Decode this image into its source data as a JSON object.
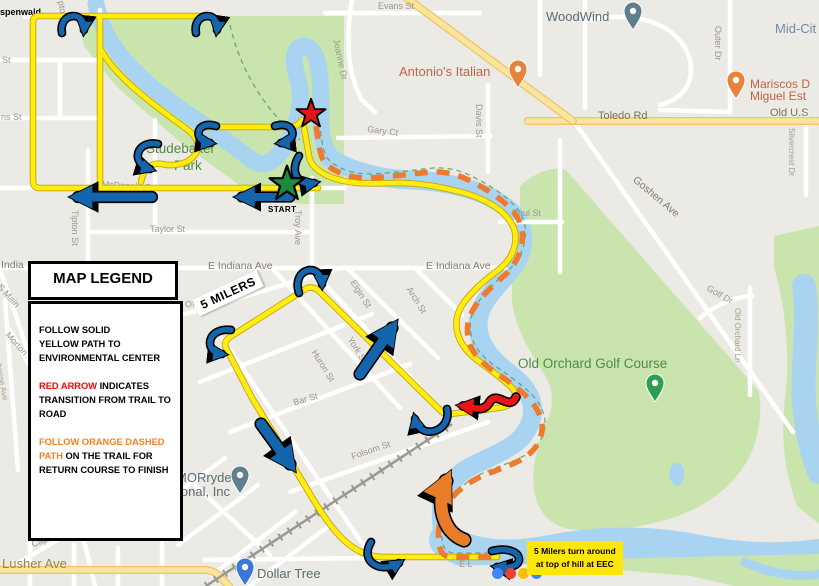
{
  "legend": {
    "title": "MAP LEGEND",
    "blocks": [
      {
        "lines": [
          {
            "parts": [
              {
                "t": "FOLLOW SOLID",
                "c": "#000000"
              }
            ]
          },
          {
            "parts": [
              {
                "t": "YELLOW PATH TO",
                "c": "#000000"
              }
            ]
          },
          {
            "parts": [
              {
                "t": "ENVIRONMENTAL CENTER",
                "c": "#000000"
              }
            ]
          }
        ]
      },
      {
        "lines": [
          {
            "parts": [
              {
                "t": "RED ARROW",
                "c": "#ff0000"
              },
              {
                "t": " INDICATES",
                "c": "#000000"
              }
            ]
          },
          {
            "parts": [
              {
                "t": "TRANSITION FROM TRAIL TO",
                "c": "#000000"
              }
            ]
          },
          {
            "parts": [
              {
                "t": "ROAD",
                "c": "#000000"
              }
            ]
          }
        ]
      },
      {
        "lines": [
          {
            "parts": [
              {
                "t": "FOLLOW ORANGE DASHED",
                "c": "#f58220"
              }
            ]
          },
          {
            "parts": [
              {
                "t": "PATH",
                "c": "#f58220"
              },
              {
                "t": " ON THE TRAIL FOR",
                "c": "#000000"
              }
            ]
          },
          {
            "parts": [
              {
                "t": "RETURN COURSE TO FINISH",
                "c": "#000000"
              }
            ]
          }
        ]
      }
    ]
  },
  "annotations": {
    "start": "START",
    "five_milers": "5 MILERS",
    "note_line1": "5 Milers turn around",
    "note_line2": "at top of hill at EEC"
  },
  "map_labels": [
    {
      "t": "spenwald",
      "x": 0,
      "y": 7,
      "r": 0,
      "c": "bold"
    },
    {
      "t": "Evans St",
      "x": 378,
      "y": 1,
      "r": 0,
      "c": "st"
    },
    {
      "t": "WoodWind",
      "x": 546,
      "y": 9,
      "r": 0,
      "c": "poi-g"
    },
    {
      "t": "Mid-Cit",
      "x": 775,
      "y": 21,
      "r": 0,
      "c": "city"
    },
    {
      "t": "Outer Dr",
      "x": 723,
      "y": 26,
      "r": 90,
      "c": "st"
    },
    {
      "t": "Joanne Dr",
      "x": 341,
      "y": 38,
      "r": 78,
      "c": "st"
    },
    {
      "t": "St",
      "x": 2,
      "y": 55,
      "r": 0,
      "c": "st"
    },
    {
      "t": "pton",
      "x": 66,
      "y": 0,
      "r": 80,
      "c": "st"
    },
    {
      "t": "Antonio's Italian",
      "x": 399,
      "y": 64,
      "r": 0,
      "c": "poi-o"
    },
    {
      "t": "Mariscos D",
      "x": 750,
      "y": 77,
      "r": 0,
      "c": "poi-o-sm"
    },
    {
      "t": "Miguel Est",
      "x": 750,
      "y": 89,
      "r": 0,
      "c": "poi-o-sm"
    },
    {
      "t": "Davis St",
      "x": 484,
      "y": 104,
      "r": 90,
      "c": "st"
    },
    {
      "t": "Old U.S",
      "x": 770,
      "y": 107,
      "r": 0,
      "c": "road"
    },
    {
      "t": "Toledo Rd",
      "x": 598,
      "y": 110,
      "r": 0,
      "c": "road"
    },
    {
      "t": "ns St",
      "x": 1,
      "y": 112,
      "r": 0,
      "c": "st"
    },
    {
      "t": "Gary Ct",
      "x": 368,
      "y": 124,
      "r": 7,
      "c": "st"
    },
    {
      "t": "Silvercrest Dr",
      "x": 796,
      "y": 128,
      "r": 90,
      "c": "st-sm"
    },
    {
      "t": "Studebaker",
      "x": 146,
      "y": 141,
      "r": 0,
      "c": "park"
    },
    {
      "t": "Park",
      "x": 174,
      "y": 158,
      "r": 0,
      "c": "park"
    },
    {
      "t": "Goshen Ave",
      "x": 638,
      "y": 174,
      "r": 40,
      "c": "st-lg"
    },
    {
      "t": "McDonald St",
      "x": 102,
      "y": 179,
      "r": 4,
      "c": "st"
    },
    {
      "t": "Paul St",
      "x": 512,
      "y": 208,
      "r": 0,
      "c": "st"
    },
    {
      "t": "Tipton St",
      "x": 80,
      "y": 210,
      "r": 90,
      "c": "st"
    },
    {
      "t": "Troy Ave",
      "x": 303,
      "y": 210,
      "r": 90,
      "c": "st"
    },
    {
      "t": "Taylor St",
      "x": 150,
      "y": 224,
      "r": 0,
      "c": "st"
    },
    {
      "t": "India",
      "x": 1,
      "y": 259,
      "r": 0,
      "c": "st-lg"
    },
    {
      "t": "E Indiana Ave",
      "x": 208,
      "y": 260,
      "r": 0,
      "c": "st-lg"
    },
    {
      "t": "E Indiana Ave",
      "x": 426,
      "y": 260,
      "r": 0,
      "c": "st-lg"
    },
    {
      "t": "Oxfor",
      "x": 184,
      "y": 300,
      "r": -12,
      "c": "st"
    },
    {
      "t": "Elgin St",
      "x": 357,
      "y": 278,
      "r": 58,
      "c": "st"
    },
    {
      "t": "Arch St",
      "x": 413,
      "y": 285,
      "r": 58,
      "c": "st"
    },
    {
      "t": "Golf Dr",
      "x": 710,
      "y": 283,
      "r": 30,
      "c": "st"
    },
    {
      "t": "S Main",
      "x": 3,
      "y": 282,
      "r": 48,
      "c": "st"
    },
    {
      "t": "Old Orchard Ln",
      "x": 742,
      "y": 308,
      "r": 90,
      "c": "st-sm"
    },
    {
      "t": "Morton",
      "x": 11,
      "y": 330,
      "r": 48,
      "c": "st"
    },
    {
      "t": "York St",
      "x": 354,
      "y": 335,
      "r": 58,
      "c": "st"
    },
    {
      "t": "Huron St",
      "x": 318,
      "y": 348,
      "r": 58,
      "c": "st"
    },
    {
      "t": "Morehouse Ave",
      "x": 0,
      "y": 345,
      "r": 80,
      "c": "st-sm"
    },
    {
      "t": "Old Orchard Golf Course",
      "x": 518,
      "y": 356,
      "r": 0,
      "c": "park"
    },
    {
      "t": "Bar St",
      "x": 292,
      "y": 398,
      "r": -17,
      "c": "st"
    },
    {
      "t": "Elizabeth St",
      "x": 270,
      "y": 424,
      "r": 58,
      "c": "st"
    },
    {
      "t": "Folsom St",
      "x": 350,
      "y": 452,
      "r": -19,
      "c": "st"
    },
    {
      "t": "MORryde",
      "x": 176,
      "y": 470,
      "r": 0,
      "c": "poi-g"
    },
    {
      "t": "ional, Inc",
      "x": 178,
      "y": 484,
      "r": 0,
      "c": "poi-g"
    },
    {
      "t": "Capi",
      "x": 30,
      "y": 540,
      "r": -22,
      "c": "st"
    },
    {
      "t": "Lusher Ave",
      "x": 2,
      "y": 556,
      "r": 0,
      "c": "road-lg"
    },
    {
      "t": "E L",
      "x": 459,
      "y": 559,
      "r": 0,
      "c": "st"
    },
    {
      "t": "Dollar Tree",
      "x": 257,
      "y": 566,
      "r": 0,
      "c": "poi-g"
    }
  ],
  "pins": [
    {
      "name": "woodwind-pin",
      "type": "place",
      "color": "#5d7f8f",
      "x": 633,
      "y": 30
    },
    {
      "name": "antonios-restaurant-pin",
      "type": "food",
      "color": "#e8823c",
      "x": 518,
      "y": 88
    },
    {
      "name": "mariscos-restaurant-pin",
      "type": "food",
      "color": "#e8823c",
      "x": 736,
      "y": 99
    },
    {
      "name": "golf-course-pin",
      "type": "golf",
      "color": "#2e9e4f",
      "x": 655,
      "y": 402
    },
    {
      "name": "morryde-pin",
      "type": "place",
      "color": "#5d7f8f",
      "x": 240,
      "y": 494
    },
    {
      "name": "dollar-tree-pin",
      "type": "shop",
      "color": "#3a78d8",
      "x": 245,
      "y": 586
    }
  ],
  "google_dots": [
    "#4285F4",
    "#EA4335",
    "#FBBC05",
    "#4285F4"
  ],
  "colors": {
    "land": "#eceae4",
    "water": "#a8d4f2",
    "park_green": "#c9e5ad",
    "road_yellow": "#fbe49b",
    "road_yellow_casing": "#eec566",
    "route_yellow": "#ffec11",
    "route_casing": "#c8a408",
    "orange_dash": "#ef7a2e",
    "arrow_blue": "#1565ad",
    "arrow_red": "#e81416",
    "arrow_orange": "#e87c28",
    "star_green": "#1d8a3c",
    "star_red": "#e31414",
    "note_bg": "#ffe60a"
  }
}
